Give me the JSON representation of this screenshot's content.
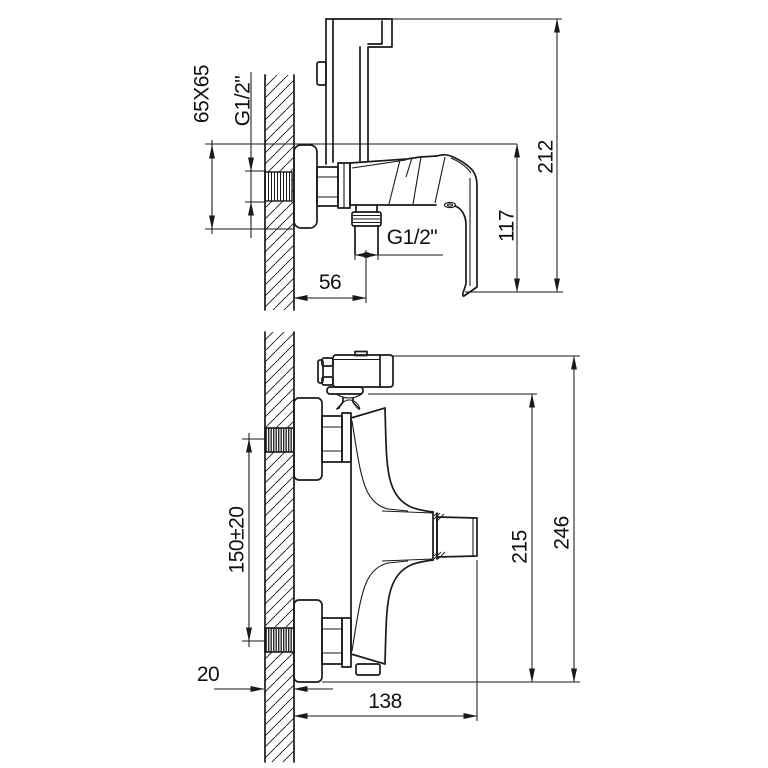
{
  "drawing": {
    "colors": {
      "background": "#ffffff",
      "line": "#1a1a1a",
      "text": "#111111"
    },
    "top_view": {
      "labels": {
        "flange_square": "65X65",
        "wall_thread": "G1/2\"",
        "total_height": "212",
        "handle_height": "117",
        "outlet_thread": "G1/2\"",
        "outlet_offset": "56"
      }
    },
    "bottom_view": {
      "labels": {
        "connection_centers": "150±20",
        "body_height": "215",
        "total_height": "246",
        "wall_thickness": "20",
        "total_depth": "138"
      }
    }
  }
}
